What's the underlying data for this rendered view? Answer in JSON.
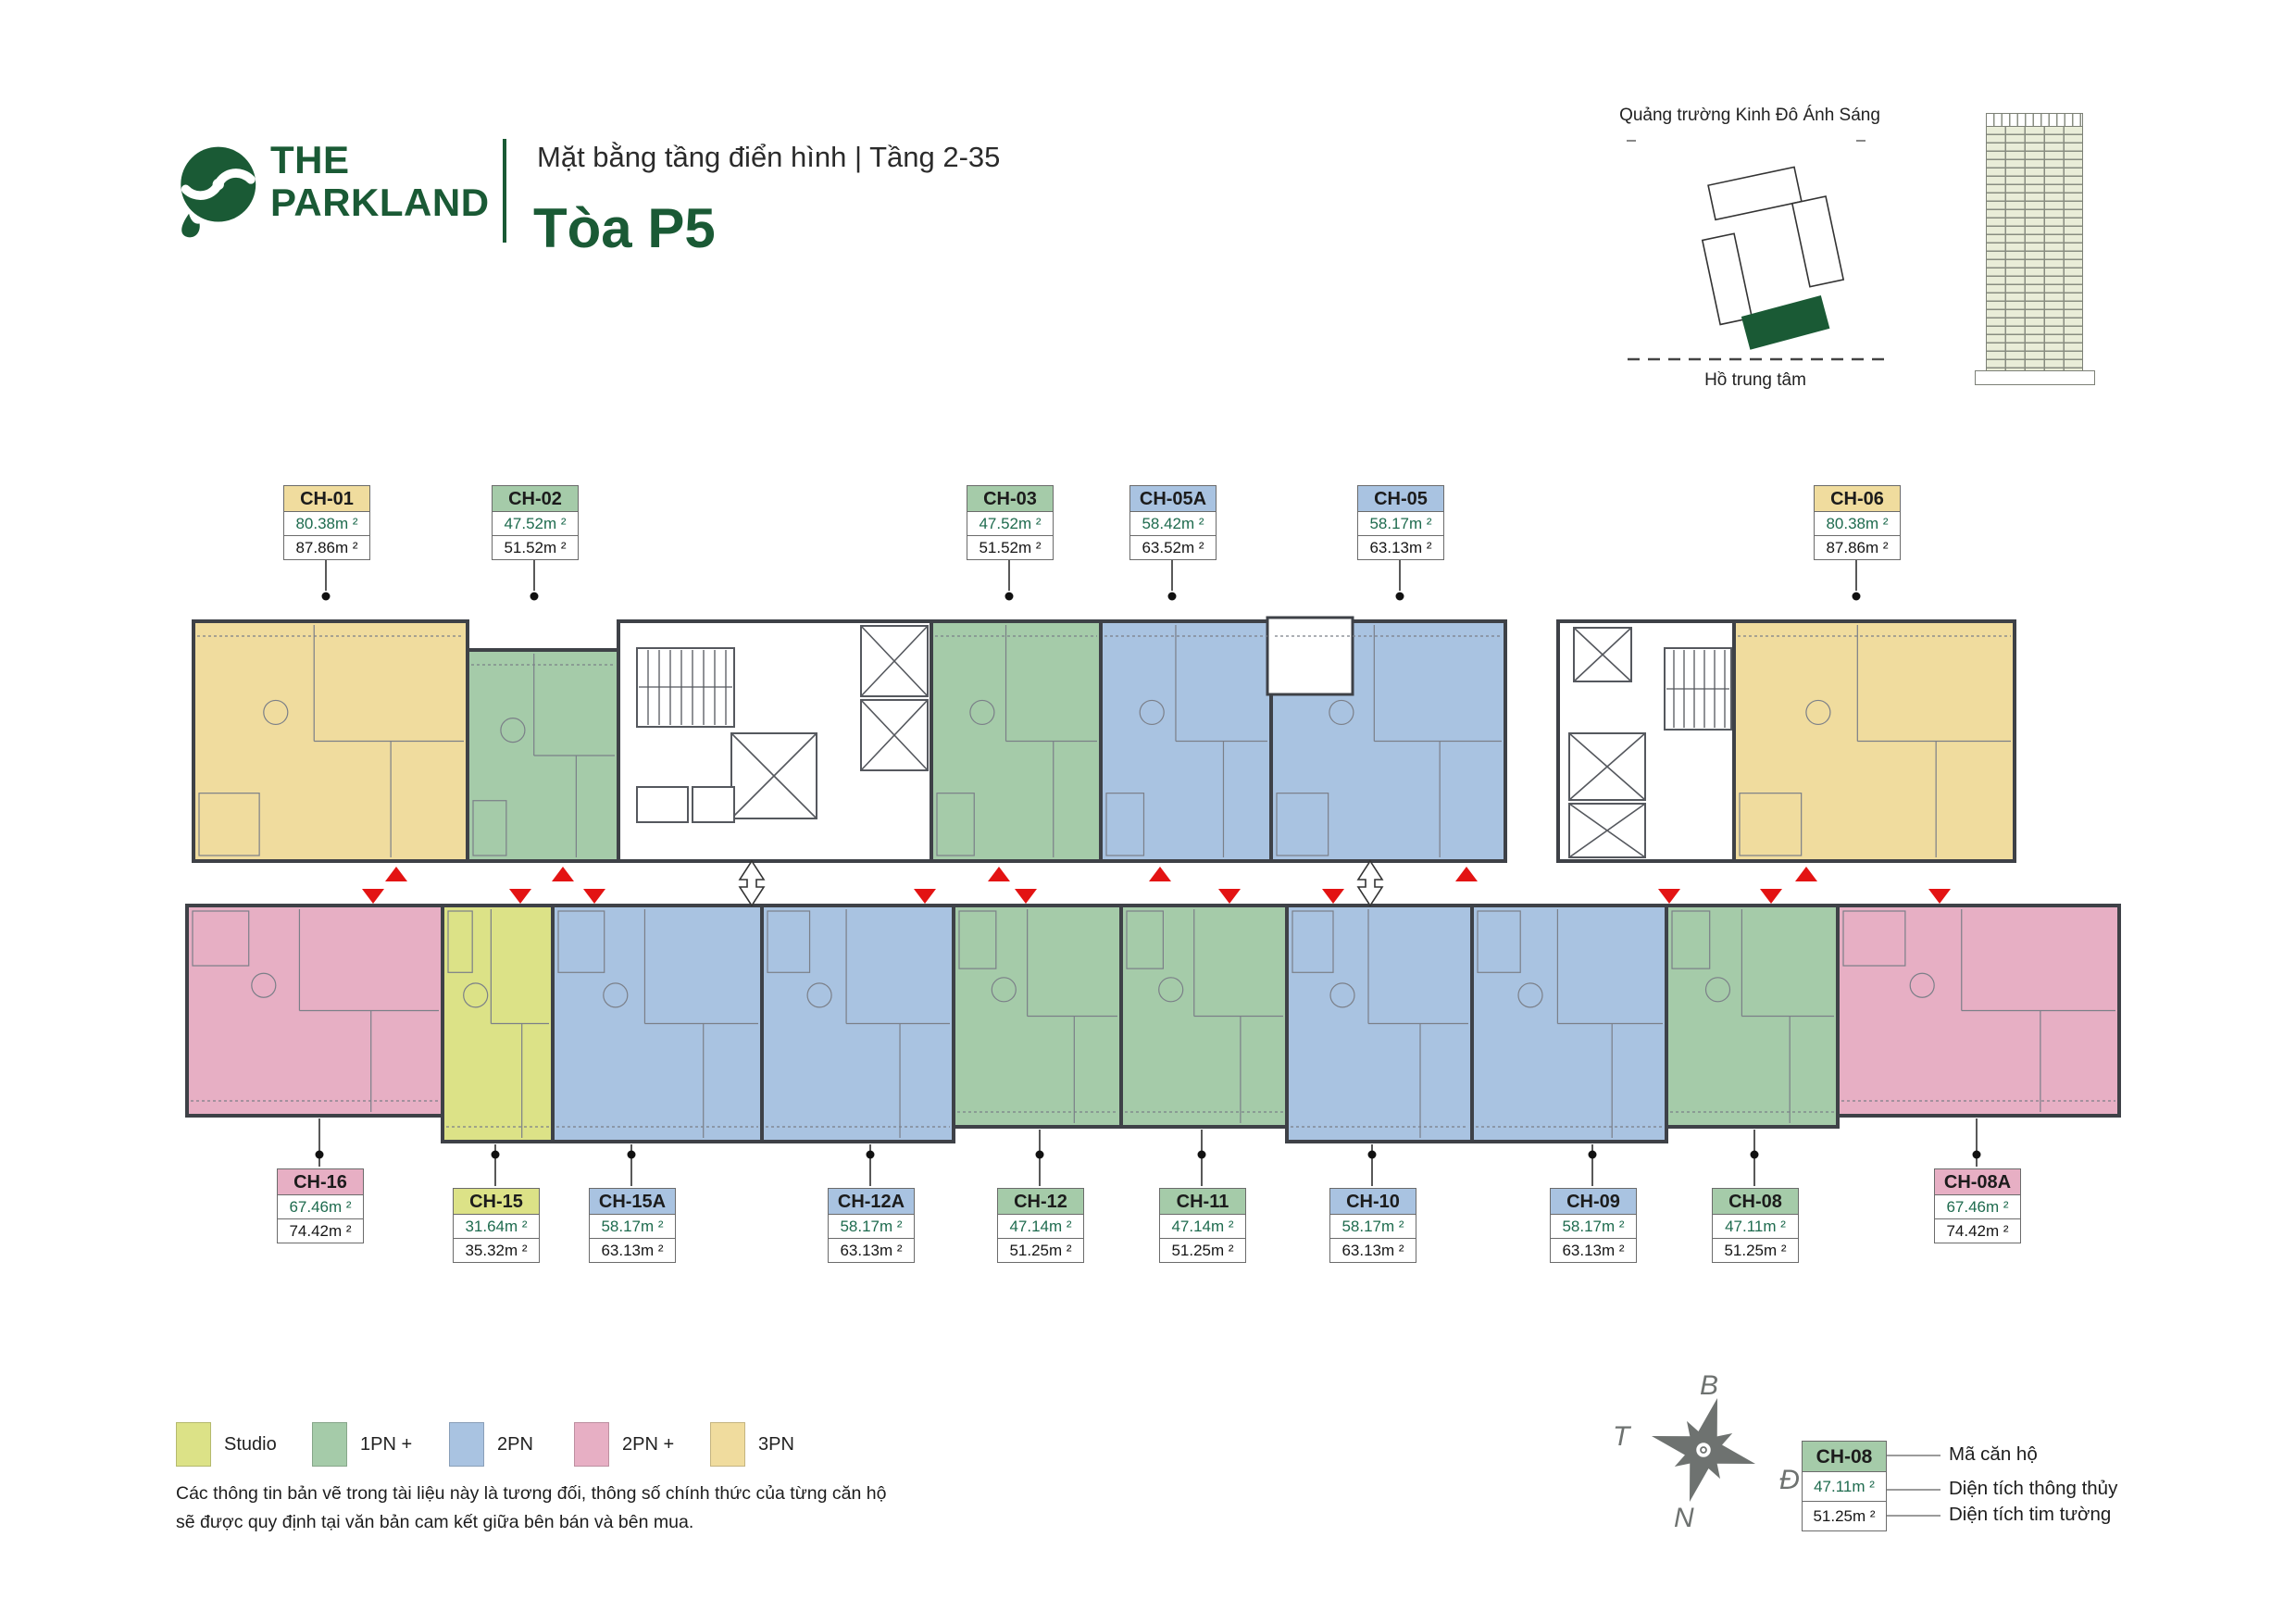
{
  "header": {
    "logo_line1": "THE",
    "logo_line2": "PARKLAND",
    "subtitle": "Mặt bằng tầng điển hình | Tầng 2-35",
    "title": "Tòa P5"
  },
  "site_map": {
    "top_label": "Quảng trường Kinh Đô Ánh Sáng",
    "bottom_label": "Hồ trung tâm"
  },
  "legend": {
    "items": [
      {
        "label": "Studio",
        "type": "studio",
        "color": "#dce287"
      },
      {
        "label": "1PN +",
        "type": "1pn",
        "color": "#a5cba9"
      },
      {
        "label": "2PN",
        "type": "2pn",
        "color": "#a9c3e1"
      },
      {
        "label": "2PN +",
        "type": "2pnp",
        "color": "#e7afc4"
      },
      {
        "label": "3PN",
        "type": "3pn",
        "color": "#f0dc9e"
      }
    ]
  },
  "disclaimer": {
    "line1": "Các thông tin bản vẽ trong tài liệu này là tương đối, thông số chính thức của từng căn hộ",
    "line2": "sẽ được quy định tại văn bản cam kết giữa bên bán và bên mua."
  },
  "compass": {
    "north": "B",
    "east": "Đ",
    "south": "N",
    "west": "T"
  },
  "key_legend": {
    "unit_id": "CH-08",
    "area1": "47.11m ²",
    "area2": "51.25m ²",
    "label_id": "Mã căn hộ",
    "label_area1": "Diện tích thông thủy",
    "label_area2": "Diện tích tim tường"
  },
  "units": [
    {
      "id": "CH-01",
      "type": "3pn",
      "area1": "80.38m ²",
      "area2": "87.86m ²"
    },
    {
      "id": "CH-02",
      "type": "1pn",
      "area1": "47.52m ²",
      "area2": "51.52m ²"
    },
    {
      "id": "CH-03",
      "type": "1pn",
      "area1": "47.52m ²",
      "area2": "51.52m ²"
    },
    {
      "id": "CH-05A",
      "type": "2pn",
      "area1": "58.42m ²",
      "area2": "63.52m ²"
    },
    {
      "id": "CH-05",
      "type": "2pn",
      "area1": "58.17m ²",
      "area2": "63.13m ²"
    },
    {
      "id": "CH-06",
      "type": "3pn",
      "area1": "80.38m ²",
      "area2": "87.86m ²"
    },
    {
      "id": "CH-16",
      "type": "2pnp",
      "area1": "67.46m ²",
      "area2": "74.42m ²"
    },
    {
      "id": "CH-15",
      "type": "studio",
      "area1": "31.64m ²",
      "area2": "35.32m ²"
    },
    {
      "id": "CH-15A",
      "type": "2pn",
      "area1": "58.17m ²",
      "area2": "63.13m ²"
    },
    {
      "id": "CH-12A",
      "type": "2pn",
      "area1": "58.17m ²",
      "area2": "63.13m ²"
    },
    {
      "id": "CH-12",
      "type": "1pn",
      "area1": "47.14m ²",
      "area2": "51.25m ²"
    },
    {
      "id": "CH-11",
      "type": "1pn",
      "area1": "47.14m ²",
      "area2": "51.25m ²"
    },
    {
      "id": "CH-10",
      "type": "2pn",
      "area1": "58.17m ²",
      "area2": "63.13m ²"
    },
    {
      "id": "CH-09",
      "type": "2pn",
      "area1": "58.17m ²",
      "area2": "63.13m ²"
    },
    {
      "id": "CH-08",
      "type": "1pn",
      "area1": "47.11m ²",
      "area2": "51.25m ²"
    },
    {
      "id": "CH-08A",
      "type": "2pnp",
      "area1": "67.46m ²",
      "area2": "74.42m ²"
    }
  ],
  "colors": {
    "brand_green": "#1a5a35",
    "arrow_red": "#e31313",
    "area_text_green": "#1e6b4e"
  }
}
